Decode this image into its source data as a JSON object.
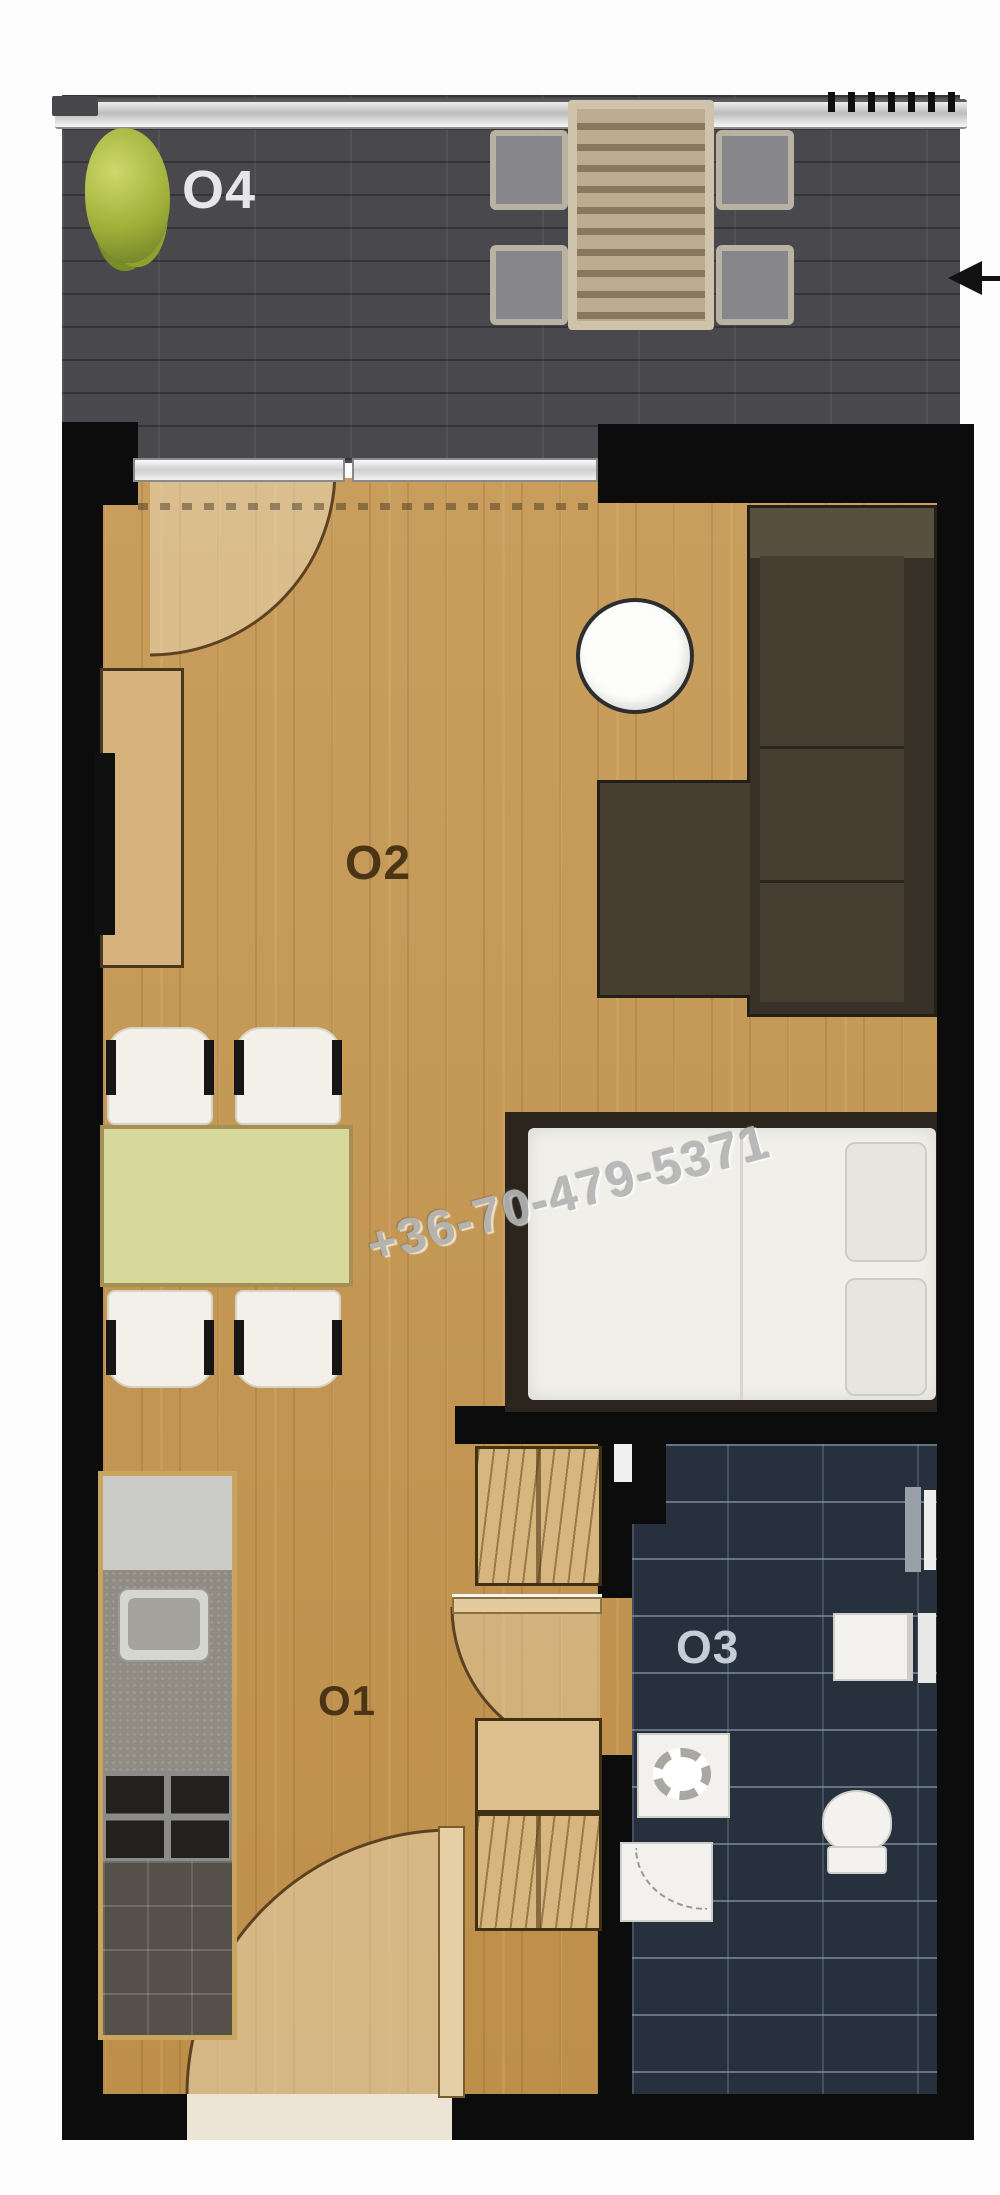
{
  "floorplan": {
    "type": "apartment-floor-plan",
    "watermark_phone": "+36-70-479-5371",
    "rooms": [
      {
        "id": "O1",
        "label": "O1",
        "name": "hallway-kitchen"
      },
      {
        "id": "O2",
        "label": "O2",
        "name": "living-room-bedroom"
      },
      {
        "id": "O3",
        "label": "O3",
        "name": "bathroom"
      },
      {
        "id": "O4",
        "label": "O4",
        "name": "balcony-terrace"
      }
    ],
    "colors": {
      "wall": "#0c0c0c",
      "wood_floor": "#c2964f",
      "balcony_tile": "#48484d",
      "bathroom_tile": "#27303d",
      "sofa": "#3d352a",
      "dining_table": "#d6d89c",
      "wardrobe_wood": "#d8b67f",
      "mattress": "#f1efe9",
      "plant_green": "#9fae38",
      "label_dark": "#4b3516",
      "label_light": "#e5e6e8"
    }
  }
}
